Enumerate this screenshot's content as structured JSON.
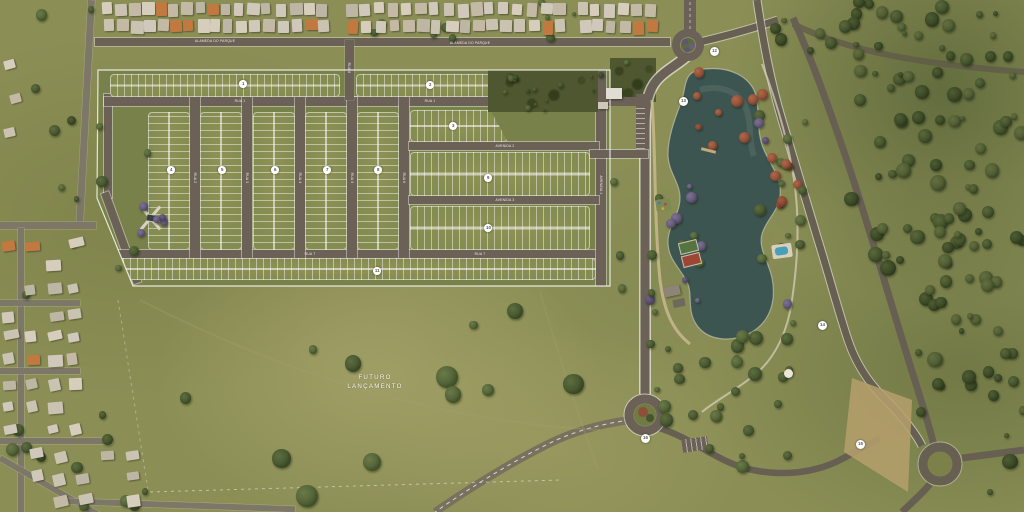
{
  "scene": {
    "description": "aerial-masterplan-rendering",
    "future_area": {
      "line1": "FUTURO",
      "line2": "LANÇAMENTO"
    }
  },
  "streets": [
    {
      "text": "ALAMEDA DO PARQUE",
      "x": 215,
      "y": 41,
      "rot": 0
    },
    {
      "text": "ALAMEDA DO PARQUE",
      "x": 470,
      "y": 43,
      "rot": 0
    },
    {
      "text": "RUA 1",
      "x": 240,
      "y": 101,
      "rot": 0
    },
    {
      "text": "RUA 1",
      "x": 430,
      "y": 101,
      "rot": 0
    },
    {
      "text": "RUA 2",
      "x": 195,
      "y": 178,
      "rot": 90
    },
    {
      "text": "RUA 3",
      "x": 247,
      "y": 178,
      "rot": 90
    },
    {
      "text": "RUA 4",
      "x": 300,
      "y": 178,
      "rot": 90
    },
    {
      "text": "RUA 5",
      "x": 352,
      "y": 178,
      "rot": 90
    },
    {
      "text": "RUA 6",
      "x": 404,
      "y": 178,
      "rot": 90
    },
    {
      "text": "RUA 7",
      "x": 310,
      "y": 254,
      "rot": 0
    },
    {
      "text": "RUA 7",
      "x": 480,
      "y": 254,
      "rot": 0
    },
    {
      "text": "RUA 8",
      "x": 349,
      "y": 68,
      "rot": 90
    },
    {
      "text": "AVENIDA 2",
      "x": 505,
      "y": 146,
      "rot": 0
    },
    {
      "text": "AVENIDA 3",
      "x": 505,
      "y": 200,
      "rot": 0
    },
    {
      "text": "AVENIDA 1",
      "x": 601,
      "y": 185,
      "rot": 90
    }
  ],
  "block_markers": [
    {
      "label": "1",
      "x": 243,
      "y": 84
    },
    {
      "label": "2",
      "x": 430,
      "y": 85
    },
    {
      "label": "3",
      "x": 453,
      "y": 126
    },
    {
      "label": "4",
      "x": 171,
      "y": 170
    },
    {
      "label": "5",
      "x": 222,
      "y": 170
    },
    {
      "label": "6",
      "x": 275,
      "y": 170
    },
    {
      "label": "7",
      "x": 327,
      "y": 170
    },
    {
      "label": "8",
      "x": 378,
      "y": 170
    },
    {
      "label": "9",
      "x": 488,
      "y": 178
    },
    {
      "label": "10",
      "x": 488,
      "y": 228
    },
    {
      "label": "11",
      "x": 377,
      "y": 271
    }
  ],
  "park_markers": [
    {
      "label": "12",
      "x": 714,
      "y": 51
    },
    {
      "label": "13",
      "x": 683,
      "y": 101
    },
    {
      "label": "14",
      "x": 822,
      "y": 325
    },
    {
      "label": "15",
      "x": 860,
      "y": 444
    },
    {
      "label": "16",
      "x": 645,
      "y": 438
    }
  ],
  "colors": {
    "grass": "#8b8f56",
    "lot_green": "#848c51",
    "estate_road": "#6b6157",
    "outer_road": "#675f52",
    "lake": "#3d5550",
    "forest": "#3e4c28",
    "autumn_tree": "#96543b",
    "jacaranda": "#5f5574",
    "promenade": "#c9b88d",
    "roof_light": "#cdc5b4",
    "roof_orange": "#c2793f",
    "pool": "#49a0b6",
    "marker_bg": "#ffffff",
    "label_text": "#ffffff"
  }
}
